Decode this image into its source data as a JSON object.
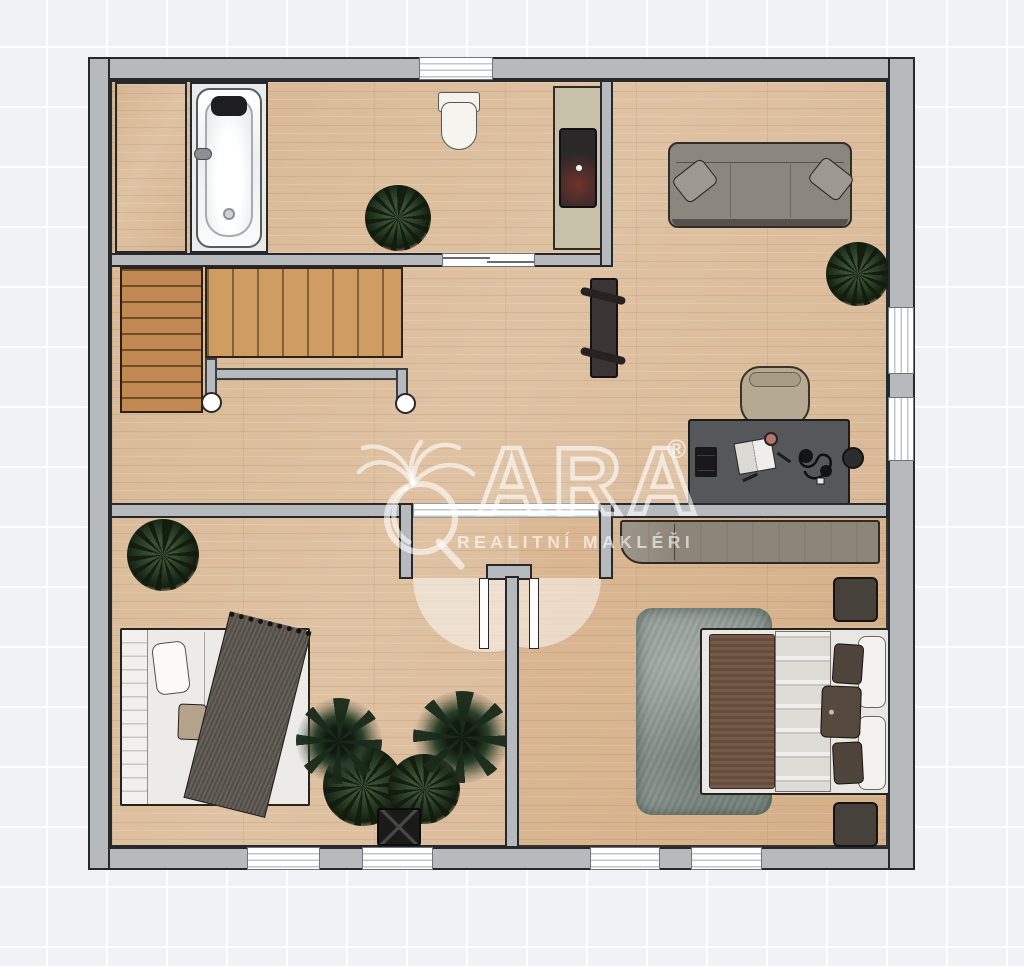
{
  "watermark": {
    "brand": "QARA",
    "brand_rest": "ARA",
    "registered": "®",
    "tagline": "REALITNÍ MAKLÉŘI"
  },
  "palette": {
    "background": "#f1f2f5",
    "grid_line": "#ffffff",
    "wall": "#b7babd",
    "wall_outline": "#26282b",
    "floor_wood": "#dcbfa0",
    "stair_dark": "#c28a52",
    "stair_light": "#cf9d62",
    "alcove": "#e9eaea",
    "sofa": "#8b867e",
    "desk": "#55575b",
    "chair": "#b5a992",
    "rug": "#8b958e",
    "sideboard": "#8d8578",
    "nightstand": "#46413b",
    "bed_white": "#edebe7",
    "blanket_gray": "#5b554f",
    "blanket_brown": "#6d5140",
    "duvet": "#dedcd7",
    "pillow_tan": "#b5a28d",
    "machine": "#2b2829",
    "pedestal": "#c6c1a8",
    "radiator": "#3a3534",
    "plant_green": "#233520",
    "watermark_white": "rgba(255,255,255,0.6)"
  },
  "rooms": [
    {
      "name": "bathroom",
      "furniture": [
        "bathtub",
        "toilet",
        "washing-machine",
        "plant",
        "closet"
      ]
    },
    {
      "name": "hallway",
      "furniture": [
        "staircase",
        "railing",
        "radiator"
      ]
    },
    {
      "name": "living-room",
      "furniture": [
        "sofa",
        "plant",
        "desk",
        "office-chair"
      ]
    },
    {
      "name": "bedroom-left",
      "furniture": [
        "double-bed",
        "plant",
        "plant-group"
      ]
    },
    {
      "name": "bedroom-right",
      "furniture": [
        "double-bed",
        "rug",
        "sideboard",
        "nightstand",
        "nightstand"
      ]
    }
  ]
}
